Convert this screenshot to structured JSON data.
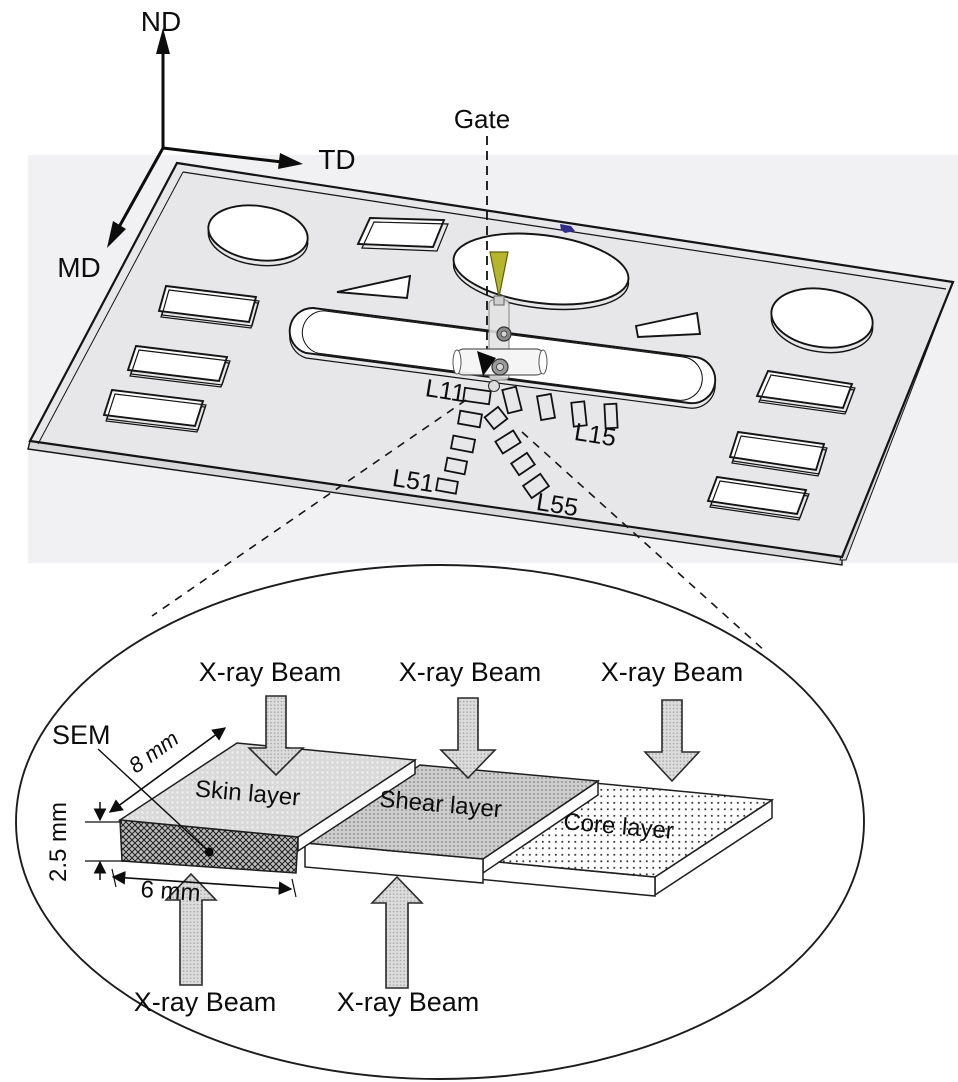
{
  "figure": {
    "axes": {
      "nd": "ND",
      "td": "TD",
      "md": "MD"
    },
    "gate": "Gate",
    "samples": {
      "l11": "L11",
      "l15": "L15",
      "l51": "L51",
      "l55": "L55"
    },
    "beams_top": [
      "X-ray Beam",
      "X-ray Beam",
      "X-ray Beam"
    ],
    "beams_bottom": [
      "X-ray Beam",
      "X-ray Beam"
    ],
    "sem": "SEM",
    "layers": {
      "skin": "Skin layer",
      "shear": "Shear layer",
      "core": "Core layer"
    },
    "dimensions": {
      "length": "8 mm",
      "thickness": "2.5 mm",
      "width": "6 mm"
    },
    "colors": {
      "gate_cone": "#b6b62e",
      "plate": "#e7e7e9",
      "band": "#f1f1f3",
      "blue_mark": "#30308c"
    }
  }
}
